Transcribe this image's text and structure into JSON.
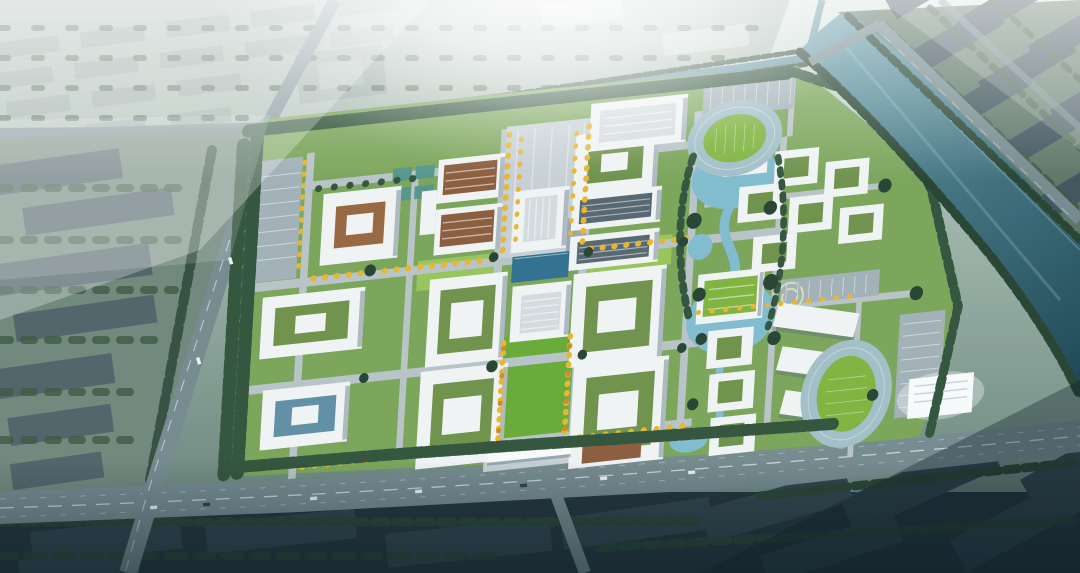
{
  "scene": {
    "type": "aerial architectural rendering of a university campus master plan",
    "regions": [
      "sun glare and atmospheric haze",
      "distant hazy city blocks to the north",
      "city blocks to the west",
      "city blocks across the river",
      "dark city blocks to the south",
      "river running along the east side",
      "waterfront canal along the north edge",
      "campus grounds",
      "central axis with golden trees",
      "main administration tower",
      "library block",
      "reflecting pool",
      "academic courtyard buildings",
      "gymnasium",
      "north athletics track",
      "south-east athletics track",
      "dormitory cluster",
      "landscape ponds and gardens",
      "main entrance gate",
      "perimeter roads and traffic"
    ]
  },
  "palette": {
    "glare": "#ffffff",
    "sky_top": "#dfe9e4",
    "sky_mid": "#9db4a9",
    "sky_low": "#5d7a72",
    "city_far_base": "#a8b9b0",
    "city_far_roof": "#99aaa6",
    "city_far_white": "#ced9d6",
    "city_left_base": "#6f867b",
    "city_left_roof": "#4f6168",
    "city_right_base": "#56705f",
    "city_right_roof": "#3f525b",
    "city_bottom_base": "#1e2e36",
    "city_bottom_roof": "#2c3e47",
    "tree_dark": "#23402e",
    "tree_mid": "#2f5138",
    "tree_city": "#3a573f",
    "tree_yellow": "#eab62c",
    "tree_orange": "#cf8c20",
    "water": "#5f97a4",
    "water_deep": "#16404f",
    "pond": "#7fbdcf",
    "pool_blue": "#2d6e8e",
    "campus_green": "#7aa557",
    "lawn_bright": "#97c657",
    "axis_lawn": "#67ab33",
    "court_lawn": "#6d9148",
    "court_blue": "#5d8ea6",
    "court_brown": "#96663e",
    "court_green_roof": "#7fb43c",
    "court_teal": "#52948a",
    "road_campus": "#bac5c9",
    "plaza_gray": "#c9d1d6",
    "parking_gray": "#a2b2b8",
    "road_city": "#73898f",
    "white": "#f3f6f7",
    "white_bright": "#fbfdfe",
    "roof_gray": "#d6dde1",
    "roof_dark": "#55656f",
    "roof_brown": "#8a5a38",
    "track_teal": "#a3bfc9",
    "shade": "#5c7080",
    "vignette": "#0e2029",
    "car_white": "#eef4f6",
    "car_dark": "#2c3a44",
    "line_white": "#e6eef0"
  }
}
